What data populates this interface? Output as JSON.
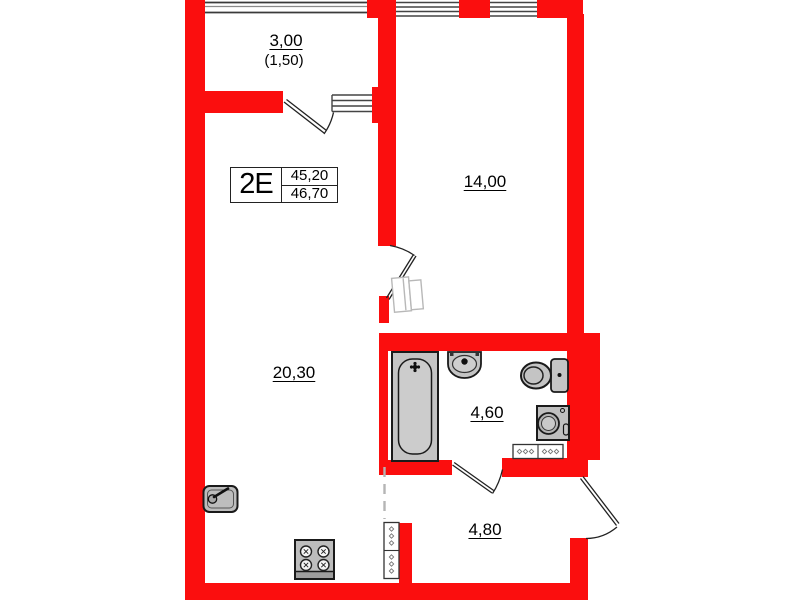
{
  "unit": {
    "code": "2E",
    "area_living": "45,20",
    "area_total": "46,70"
  },
  "rooms": {
    "balcony": {
      "area": "3,00",
      "area_coefficient": "(1,50)"
    },
    "bedroom": {
      "area": "14,00"
    },
    "living_kitchen": {
      "area": "20,30"
    },
    "bathroom": {
      "area": "4,60"
    },
    "hallway": {
      "area": "4,80"
    }
  },
  "colors": {
    "wall": "#fb0e0e",
    "fixture_fill": "#c4c4c4",
    "outline": "#1a1a1a",
    "ghost": "#b8b8b8"
  }
}
